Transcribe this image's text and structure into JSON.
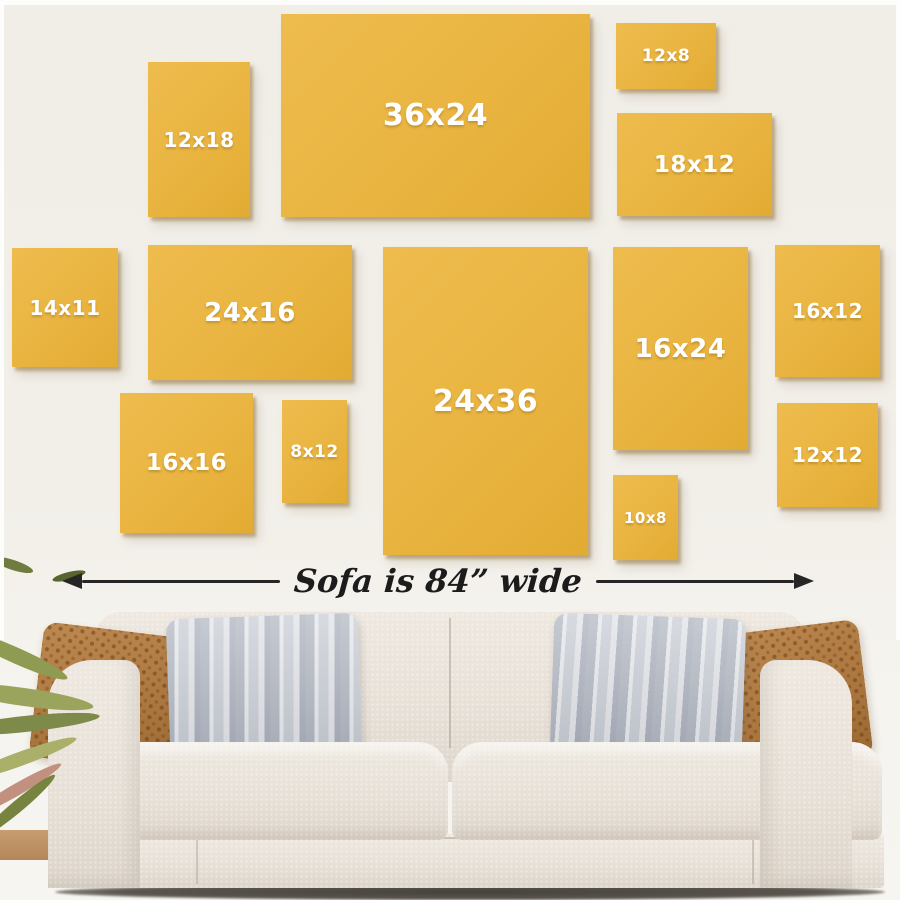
{
  "caption": "Sofa is 84” wide",
  "frames": [
    {
      "label": "12x18",
      "width_in": 12,
      "height_in": 18
    },
    {
      "label": "36x24",
      "width_in": 36,
      "height_in": 24
    },
    {
      "label": "12x8",
      "width_in": 12,
      "height_in": 8
    },
    {
      "label": "18x12",
      "width_in": 18,
      "height_in": 12
    },
    {
      "label": "14x11",
      "width_in": 14,
      "height_in": 11
    },
    {
      "label": "24x16",
      "width_in": 24,
      "height_in": 16
    },
    {
      "label": "24x36",
      "width_in": 24,
      "height_in": 36
    },
    {
      "label": "16x24",
      "width_in": 16,
      "height_in": 24
    },
    {
      "label": "16x12",
      "width_in": 16,
      "height_in": 12
    },
    {
      "label": "12x12",
      "width_in": 12,
      "height_in": 12
    },
    {
      "label": "16x16",
      "width_in": 16,
      "height_in": 16
    },
    {
      "label": "8x12",
      "width_in": 8,
      "height_in": 12
    },
    {
      "label": "10x8",
      "width_in": 10,
      "height_in": 8
    }
  ],
  "colors": {
    "wall": "#f2efe9",
    "canvas_yellow": "#e9b440",
    "canvas_shadow": "#8c6928",
    "arrow": "#262626",
    "sofa_fabric": "#e7e0d7",
    "pillow_brown": "#ad7840",
    "pillow_gray": "#c6cbd3",
    "plant_green": "#8f9a52",
    "label_text": "#ffffff"
  }
}
